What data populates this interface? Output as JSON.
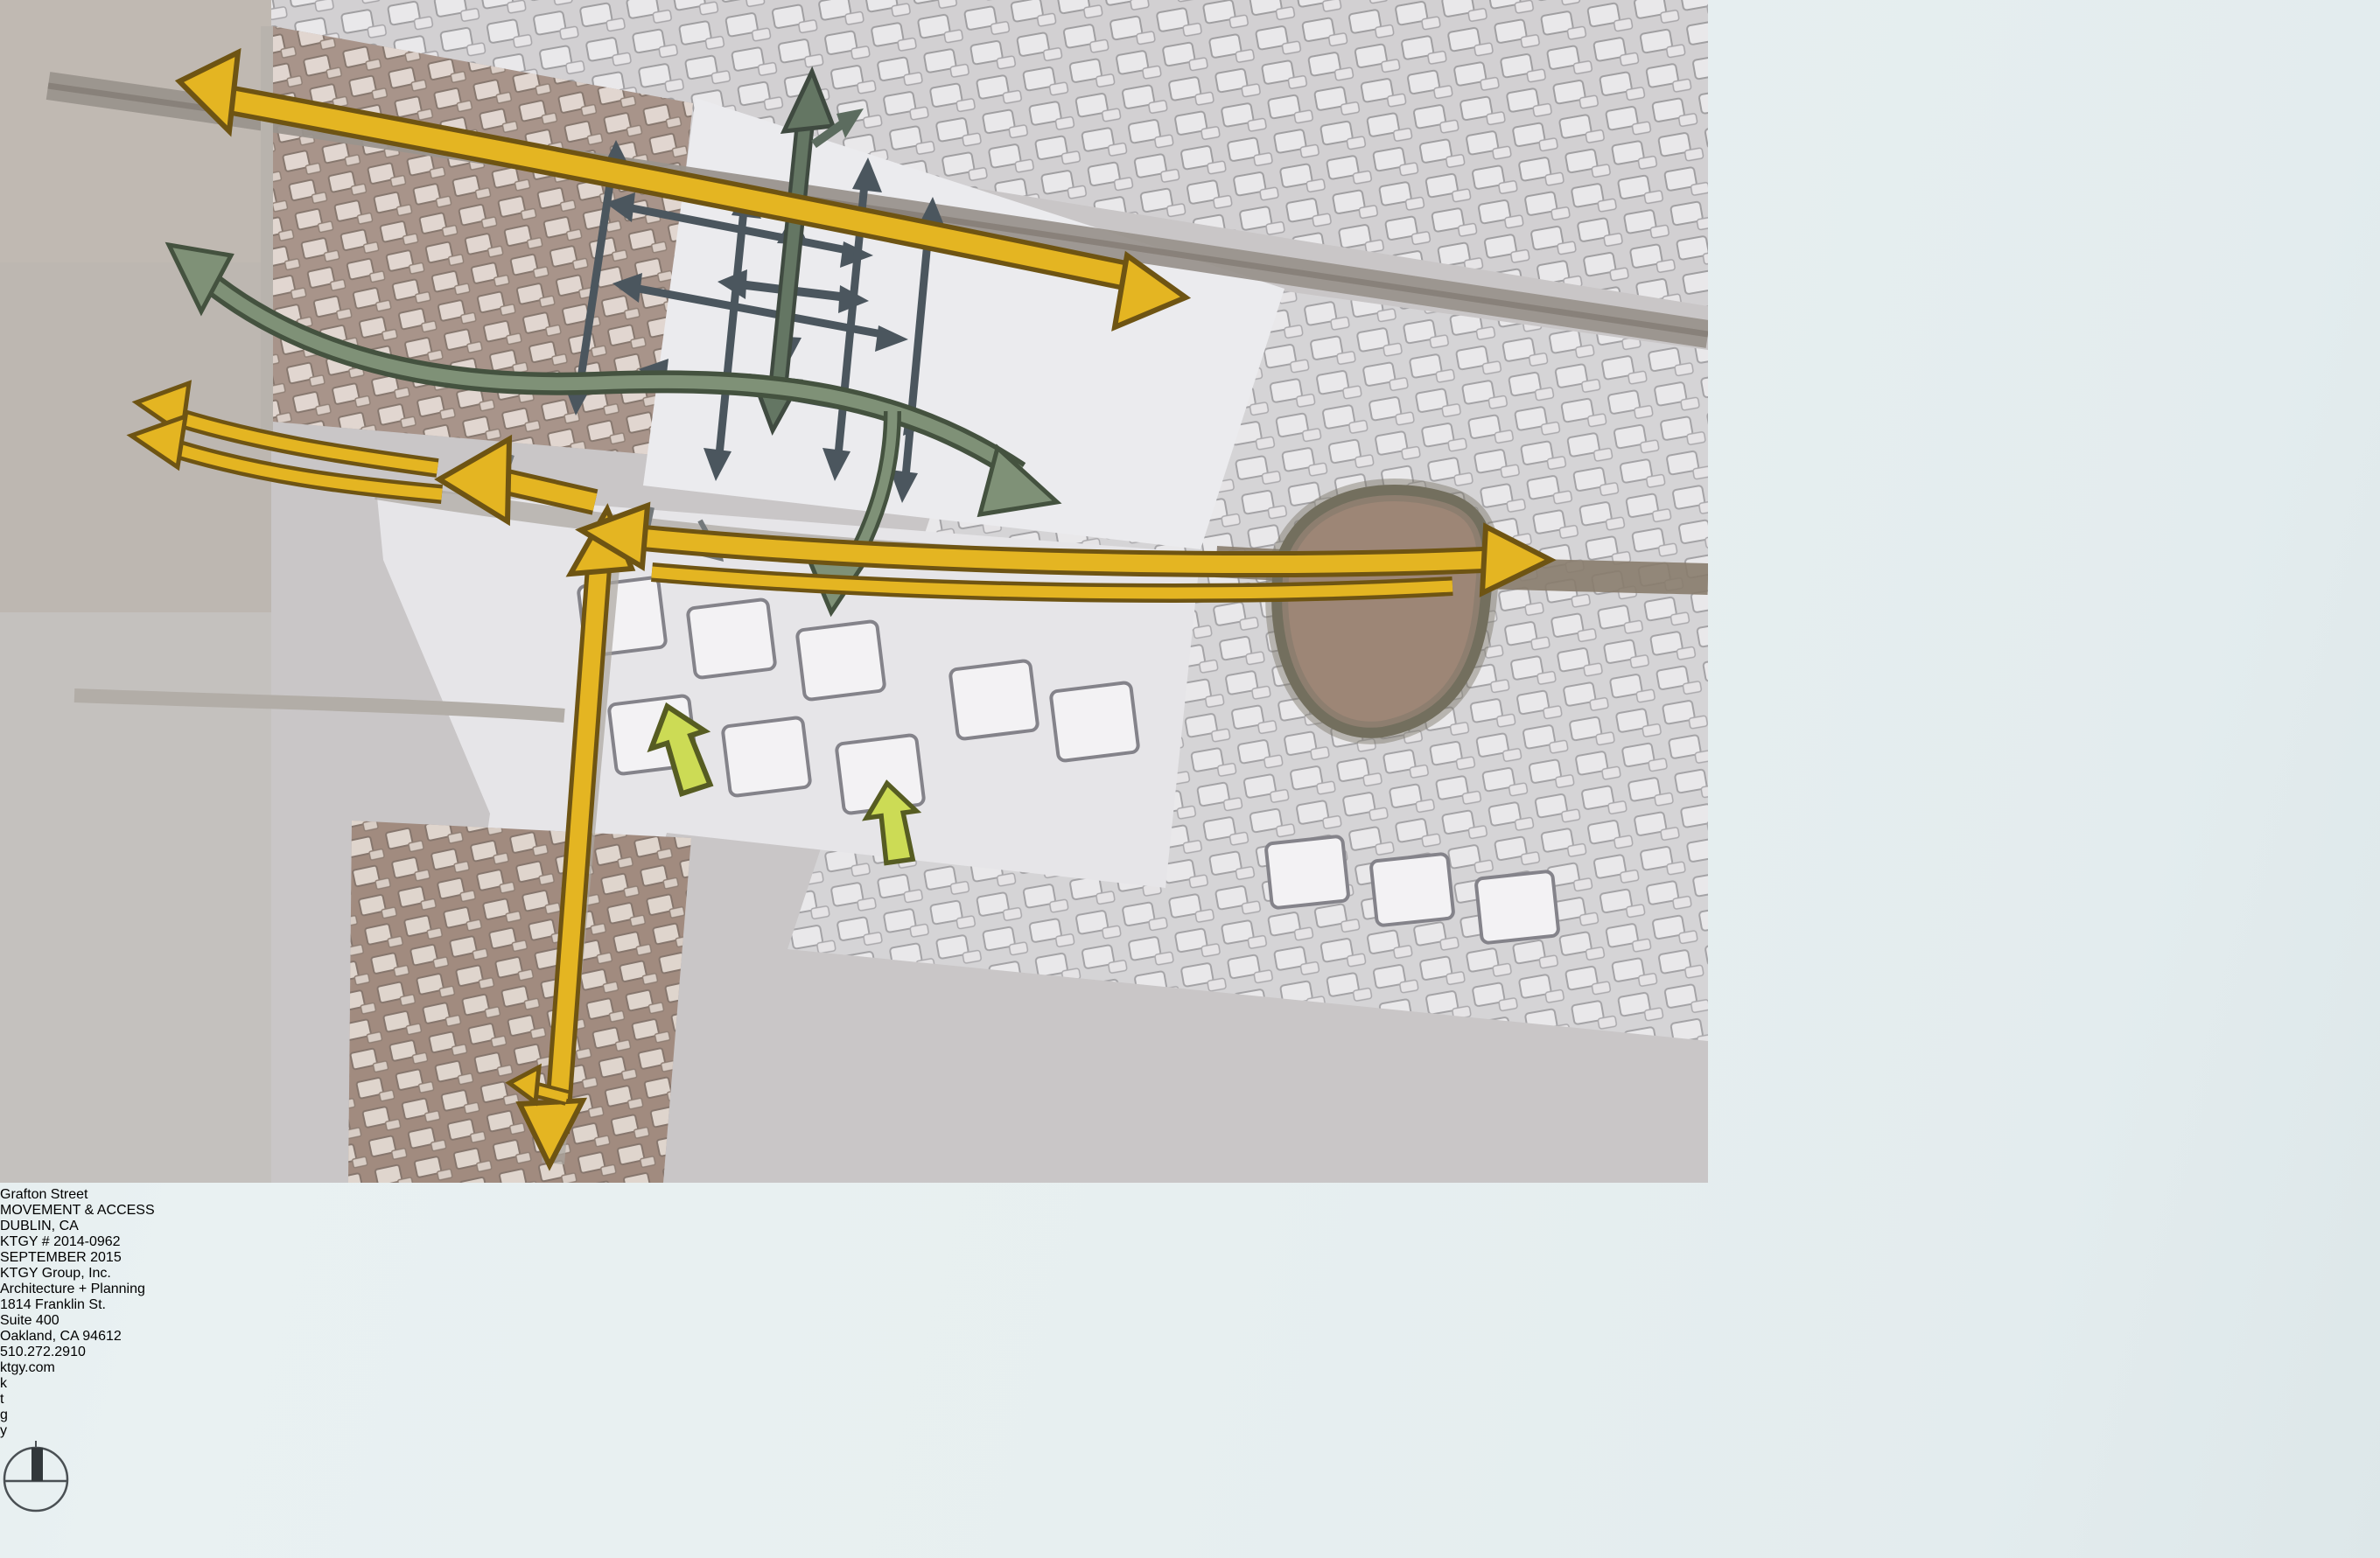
{
  "slide": {
    "project_title": "Grafton Street",
    "sheet_title": "MOVEMENT & ACCESS",
    "location": "DUBLIN, CA",
    "project_number": "KTGY # 2014-0962",
    "date": "SEPTEMBER 2015"
  },
  "firm": {
    "lines": [
      "KTGY Group, Inc.",
      "Architecture + Planning",
      "1814 Franklin St.",
      "Suite 400",
      "Oakland, CA 94612",
      "510.272.2910",
      "ktgy.com"
    ],
    "logo_letters": [
      "k",
      "t",
      "g",
      "y"
    ],
    "logo_bar_color": "#8DA23C",
    "logo_letter_color": "#D7E49C"
  },
  "map": {
    "kind": "aerial-site-plan",
    "arrow_colors": {
      "primary_arterial_yellow": "#E4B522",
      "secondary_route_sage": "#7F9177",
      "internal_street_slate": "#4B565E",
      "pedestrian_entry_chartreuse": "#CCDB55"
    },
    "features": [
      "pond",
      "residential-blocks",
      "central-parcel",
      "arterial-roads"
    ]
  }
}
